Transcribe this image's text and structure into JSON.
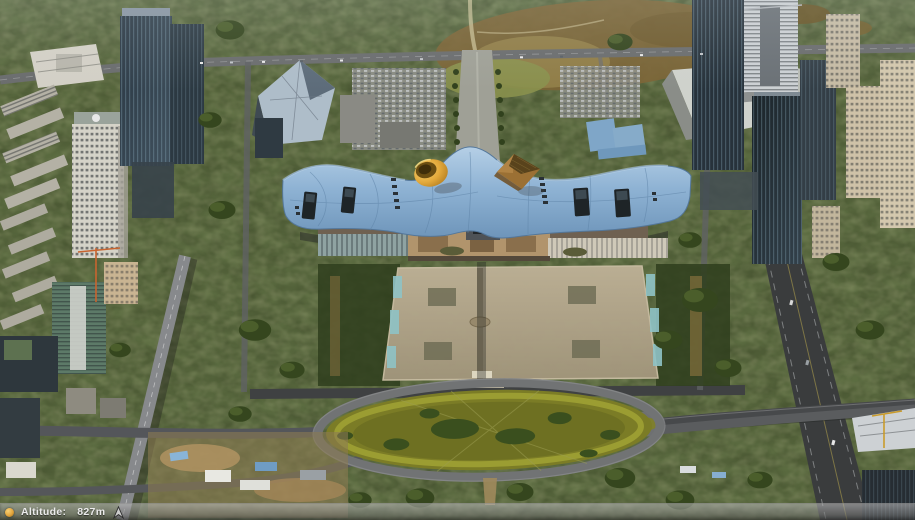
{
  "app": {
    "view_type": "3d-aerial-map-view"
  },
  "hud": {
    "altitude_label": "Altitude:",
    "altitude_value": "827m",
    "status_icon": "orange-status-dot-icon",
    "heading_icon": "navigation-arrow-icon"
  },
  "colors": {
    "hud-bar-top": "rgba(185,185,185,0.60)",
    "hud-bar-bottom": "rgba(82,82,82,0.58)",
    "hud-text": "#ececec",
    "status-dot": "#e2a43c",
    "tree-base": "#44502e",
    "tree-dark": "#2f3e1d",
    "grass-olive": "#7b7c26",
    "road-gray": "#5d5f60",
    "plaza-tan": "#b0a287",
    "roof-blue": "#8fb3d4",
    "cone-yellow": "#e3a93b",
    "pyramid-brown": "#9b7034",
    "glass-dark": "#27323b",
    "concrete-light": "#d5d3c8"
  }
}
